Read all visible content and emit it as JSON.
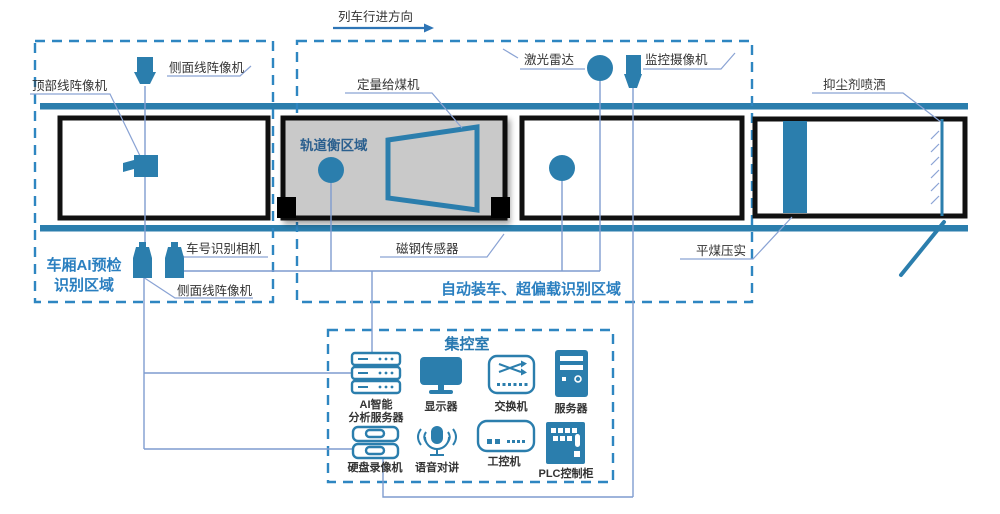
{
  "direction": {
    "label": "列车行进方向"
  },
  "regions": {
    "left_line1": "车厢AI预检",
    "left_line2": "识别区域",
    "middle": "自动装车、超偏载识别区域",
    "track_scale": "轨道衡区域",
    "control_room": "集控室"
  },
  "field_labels": {
    "top_line_camera": "顶部线阵像机",
    "side_line_camera_top": "侧面线阵像机",
    "side_line_camera_bottom": "侧面线阵像机",
    "car_number_camera": "车号识别相机",
    "coal_feeder": "定量给煤机",
    "laser_radar": "激光雷达",
    "cctv_camera": "监控摄像机",
    "dust_spray": "抑尘剂喷洒",
    "magnetic_sensor": "磁钢传感器",
    "coal_compaction": "平煤压实"
  },
  "control_room_devices": {
    "ai_server_line1": "AI智能",
    "ai_server_line2": "分析服务器",
    "monitor": "显示器",
    "network_switch": "交换机",
    "server": "服务器",
    "dvr": "硬盘录像机",
    "voice_intercom": "语音对讲",
    "industrial_pc": "工控机",
    "plc_cabinet": "PLC控制柜"
  },
  "colors": {
    "primary_blue": "#2B7EAD",
    "dashed_blue": "#2E86C1",
    "region_label_blue": "#2A7FC0",
    "track_scale_label_blue": "#2B5F8E",
    "connector_blue": "#7F9CCF",
    "label_text": "#333333",
    "wagon_border": "#111111",
    "scale_area_gray": "#C9C9C9"
  }
}
